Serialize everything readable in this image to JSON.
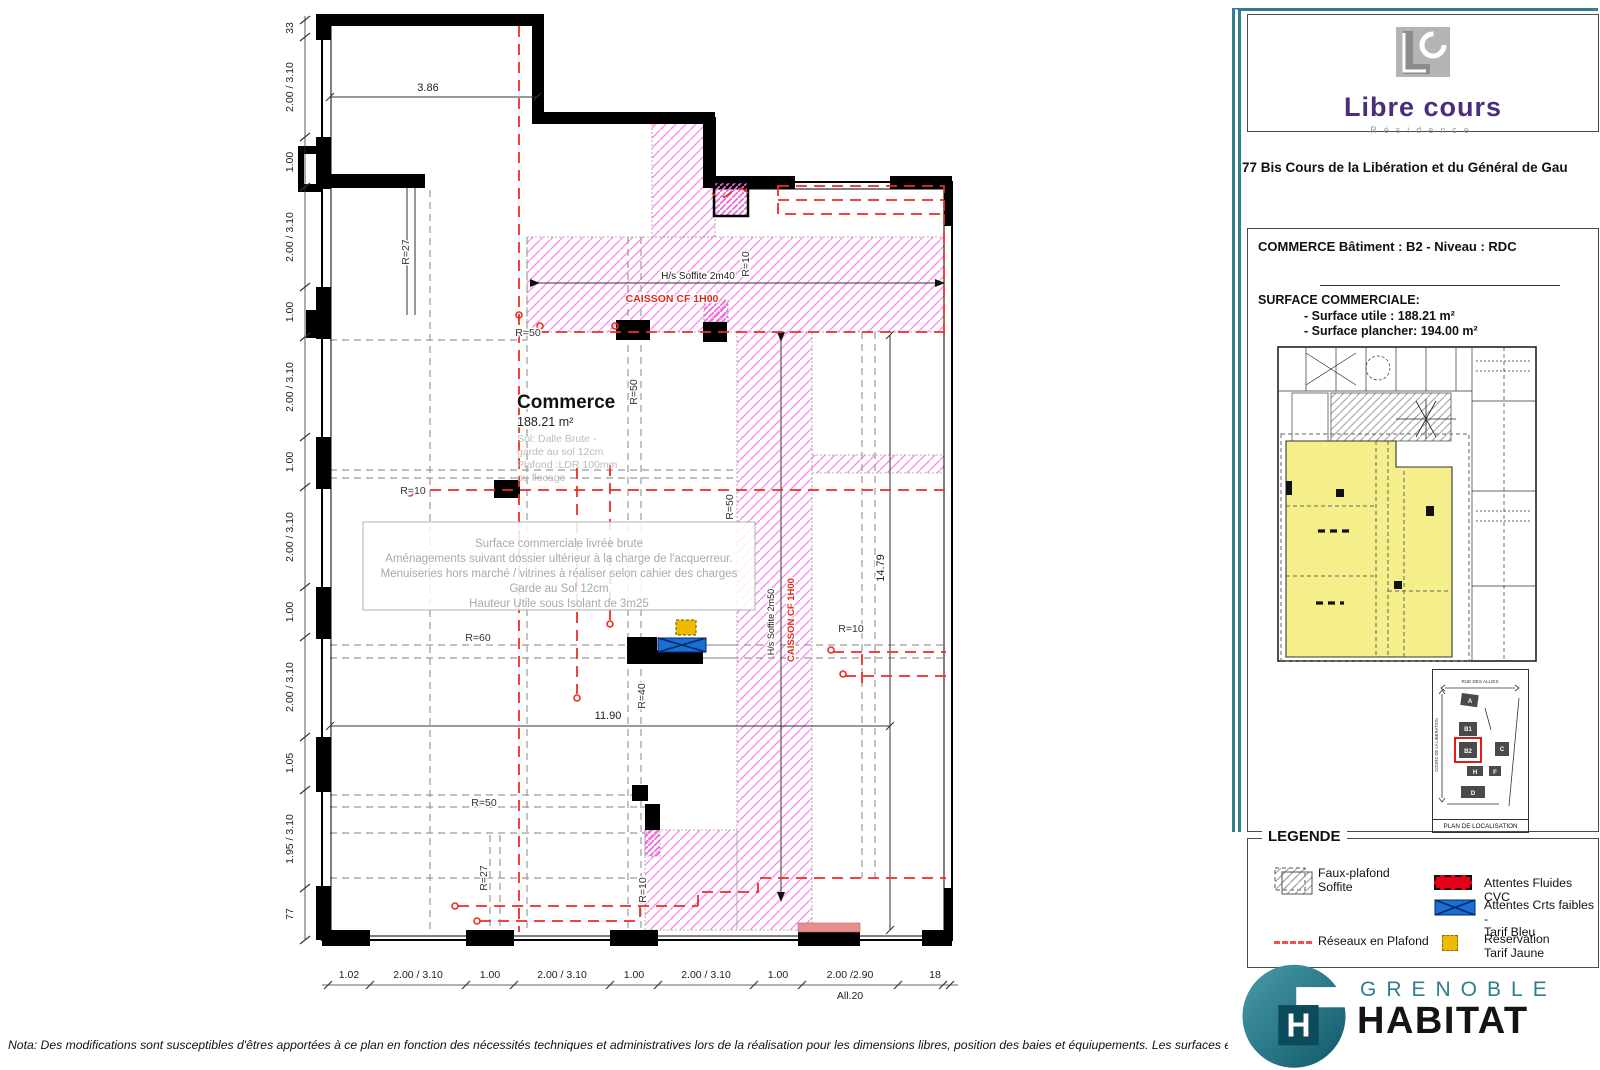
{
  "colors": {
    "teal": "#2e7e8e",
    "magenta_hatch": "#ff8cf0",
    "red_network": "#ef2d24",
    "legend_red": "#e50019",
    "legend_blue": "#1a6fd0",
    "legend_yellow": "#edba00",
    "brand_purple": "#4a2d7d",
    "keyplan_yellow": "#f4ef8a"
  },
  "plan": {
    "room": {
      "name": "Commerce",
      "area": "188.21 m²",
      "notes": [
        "Sol: Dalle Brute -",
        "garde au sol 12cm",
        "Plafond :LDR 100mm",
        "ou flocage"
      ]
    },
    "note_box": {
      "l1": "Surface commerciale livrée brute",
      "l2": "Aménagements suivant dossier ultérieur à la charge de l'acquerreur.",
      "l3": "Menuiseries hors marché / vitrines à réaliser selon cahier des charges",
      "l4": "Garde au Sol 12cm",
      "l5": "Hauteur Utile sous Isolant de 3m25"
    },
    "soffit_h": {
      "label": "H/s Soffite 2m40",
      "caisson": "CAISSON CF 1H00"
    },
    "soffit_v": {
      "label": "H/s Soffite 2m50",
      "caisson": "CAISSON CF 1H00"
    },
    "dims": {
      "top": "3.86",
      "mid": "11.90",
      "right": "14.79"
    },
    "radius": {
      "r27_top": "R=27",
      "r10_top": "R=10",
      "r50_a": "R=50",
      "r50_b": "R=50",
      "r10_left": "R=10",
      "r50_c": "R=50",
      "r60": "R=60",
      "r40": "R=40",
      "r50_d": "R=50",
      "r27_bottom": "R=27",
      "r10_bottom": "R=10",
      "r10_right": "R=10"
    },
    "left_dims": [
      "33",
      "2.00 / 3.10",
      "1.00",
      "2.00 / 3.10",
      "1.00",
      "2.00 / 3.10",
      "1.00",
      "2.00 / 3.10",
      "1.00",
      "2.00 / 3.10",
      "1.05",
      "1.95 / 3.10",
      "77"
    ],
    "bottom_dims": [
      "1.02",
      "2.00 / 3.10",
      "1.00",
      "2.00 / 3.10",
      "1.00",
      "2.00 / 3.10",
      "1.00",
      "2.00 /2.90",
      "18"
    ],
    "bottom_extra": "All.20"
  },
  "title_block": {
    "logo": {
      "initials": "LC",
      "name": "Libre cours",
      "subtitle": "Résidence"
    },
    "address": "77 Bis Cours de la Libération et du Général de Gau",
    "building_line": "COMMERCE Bâtiment : B2 - Niveau : RDC",
    "surface_title": "SURFACE COMMERCIALE:",
    "surface_utile": "- Surface utile : 188.21 m²",
    "surface_plancher": "- Surface plancher: 194.00 m²",
    "location_label": "PLAN DE LOCALISATION",
    "map": {
      "street_top": "RUE DES ALLIES",
      "street_left": "COURS DE LA LIBERATION",
      "blocks": {
        "a": "A",
        "b1": "B1",
        "b2": "B2",
        "c": "C",
        "h": "H",
        "f": "F",
        "d": "D"
      }
    },
    "legend": {
      "title": "LEGENDE",
      "faux_plafond_1": "Faux-plafond",
      "faux_plafond_2": "Soffite",
      "reseaux": "Réseaux en Plafond",
      "cvc": "Attentes Fluides CVC",
      "crt_1": "Attentes Crts faibles -",
      "crt_2": "Tarif Bleu",
      "resa_1": "Reservation",
      "resa_2": "Tarif Jaune"
    },
    "footer_logo": {
      "line1": "GRENOBLE",
      "line2": "HABITAT",
      "mark": "H"
    }
  },
  "nota": "Nota: Des modifications sont susceptibles d'êtres apportées à ce plan en fonction des nécessités techniques et administratives lors de la réalisation pour les dimensions libres, position des baies et équiupements. Les surfaces et hauteurs sous"
}
